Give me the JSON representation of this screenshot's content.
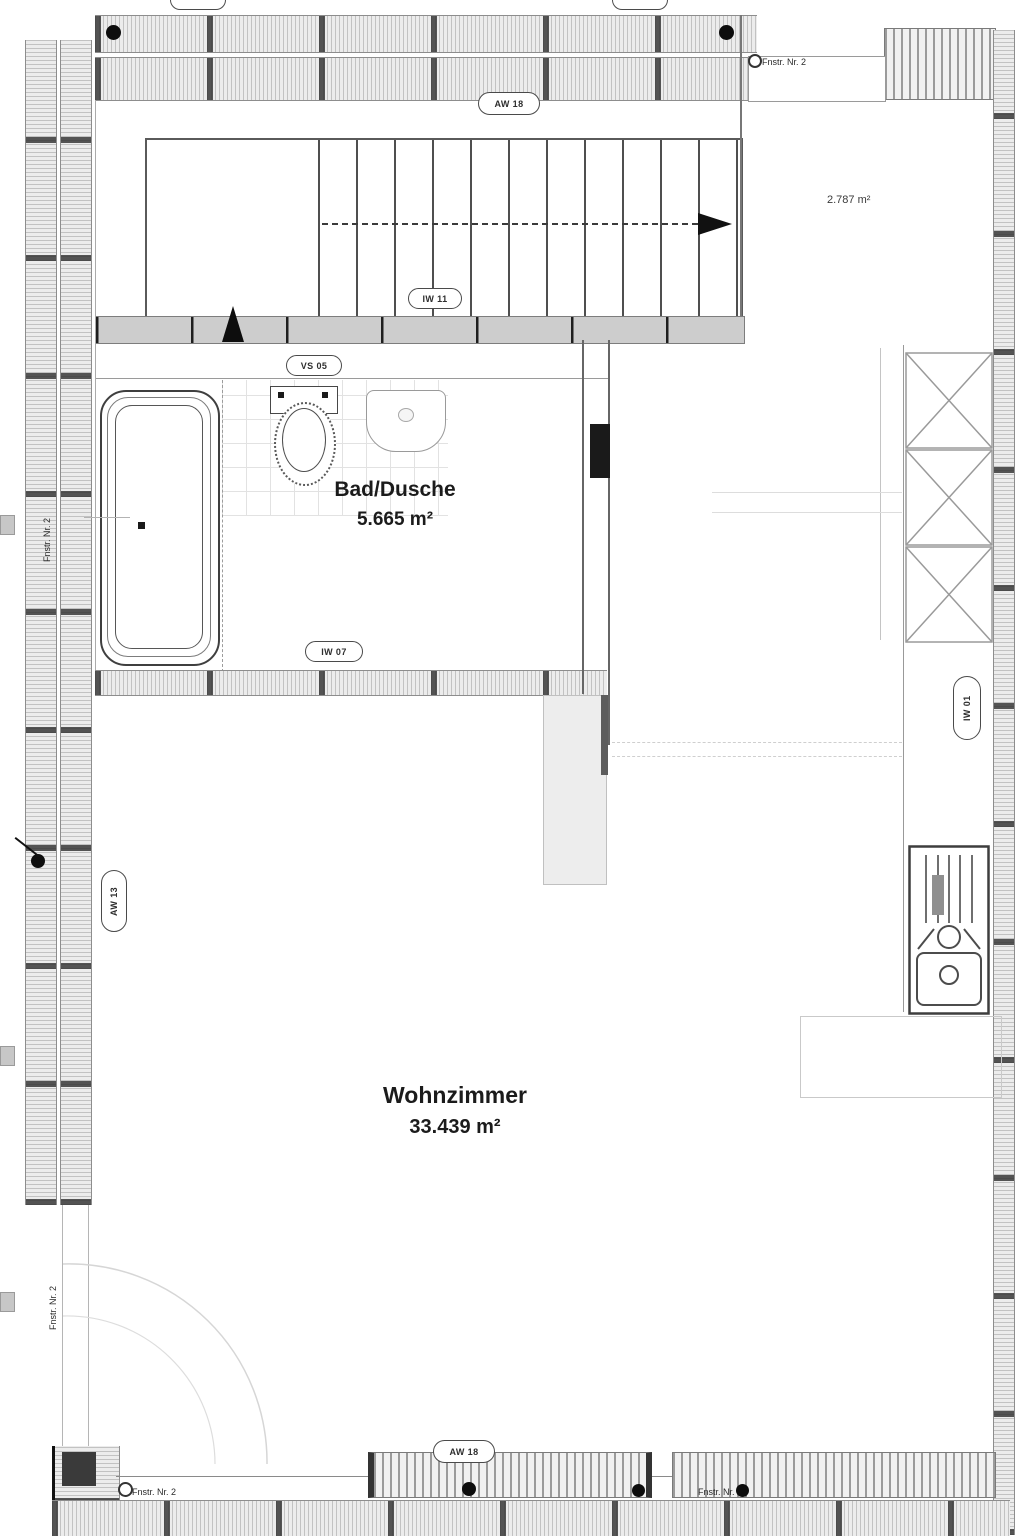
{
  "plan": {
    "rooms": [
      {
        "id": "bad",
        "name": "Bad/Dusche",
        "area": "5.665 m²"
      },
      {
        "id": "wohnzimmer",
        "name": "Wohnzimmer",
        "area": "33.439 m²"
      }
    ],
    "stair_area_label": "2.787 m²",
    "window_labels": {
      "top_right": "Fnstr. Nr. 2",
      "bottom_left": "Fnstr. Nr. 2",
      "bottom_right": "Fnstr. Nr. 2",
      "left_upper": "Fnstr. Nr. 2",
      "left_lower": "Fnstr. Nr. 2"
    },
    "wall_tags": {
      "top": "AW 18",
      "stairs": "IW 11",
      "bath_top": "VS 05",
      "bath_bottom": "IW 07",
      "bottom": "AW 18",
      "right_vertical": "IW 01",
      "left_vertical": "AW 13"
    }
  }
}
